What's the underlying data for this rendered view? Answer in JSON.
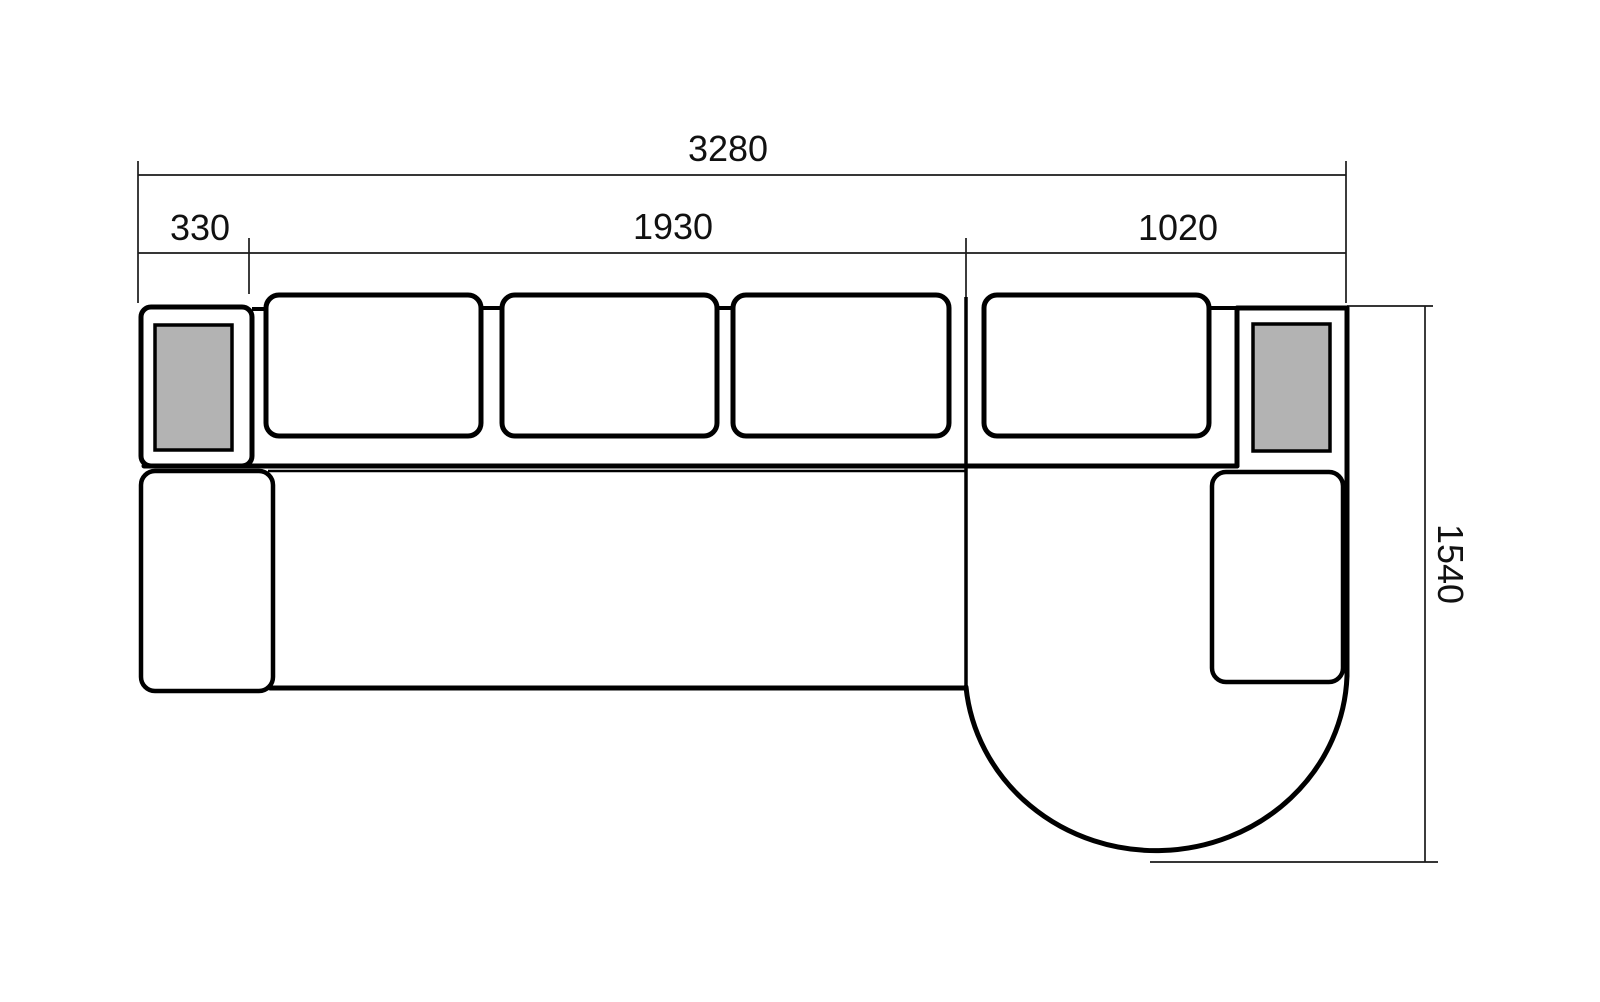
{
  "drawing": {
    "subject": "corner sofa with chaise - top view technical drawing",
    "labels": {
      "total_width": "3280",
      "segment_left_arm": "330",
      "segment_seats": "1930",
      "segment_chaise": "1020",
      "total_depth": "1540"
    },
    "colors": {
      "outline": "#000000",
      "dimension": "#1a1a1a",
      "pillow_fill": "#b3b3b3",
      "background": "#ffffff"
    }
  }
}
